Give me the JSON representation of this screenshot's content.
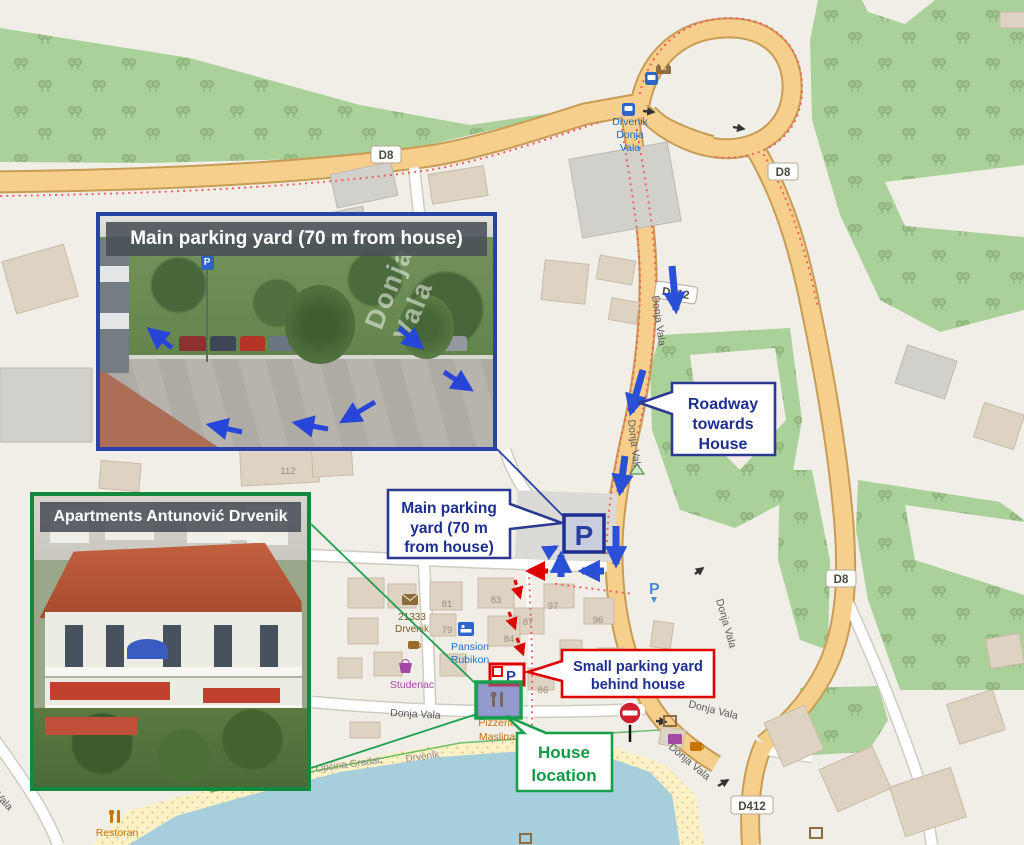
{
  "photos": {
    "main_parking": {
      "title": "Main parking yard (70 m from house)",
      "street_text": "Donja Vala"
    },
    "apartments": {
      "title": "Apartments Antunović Drvenik"
    }
  },
  "callouts": {
    "roadway": {
      "lines": [
        "Roadway",
        "towards",
        "House"
      ]
    },
    "main_parking": {
      "lines": [
        "Main parking",
        "yard (70 m",
        "from house)"
      ]
    },
    "small_parking": {
      "lines": [
        "Small parking yard",
        "behind house"
      ]
    },
    "house_location": {
      "lines": [
        "House",
        "location"
      ]
    }
  },
  "map": {
    "shields": [
      "D8",
      "D8",
      "D8",
      "D412",
      "D412"
    ],
    "street": "Donja Vala",
    "parking_symbol": "P",
    "bus_stop_lines": [
      "Drvenik",
      "Donja",
      "Vala"
    ],
    "post_lines": [
      "21333",
      "Drvenik"
    ],
    "pansion_lines": [
      "Pansion",
      "Rubikon"
    ],
    "supermarket": "Studenac",
    "pizzeria_lines": [
      "Pizzeria",
      "Maslina"
    ],
    "restaurant": "Restoran",
    "municipality": "Općina Gradac",
    "village": "Drvenik",
    "house_numbers": [
      "111",
      "112",
      "81",
      "83",
      "79",
      "84",
      "87",
      "97",
      "96",
      "86"
    ]
  },
  "colors": {
    "navy": "#1e2f8f",
    "arrow_blue": "#2a50d6",
    "red": "#e00000",
    "green": "#17a04b",
    "forest": "#abd19b",
    "water": "#a6cfdb",
    "road": "#f7cf8d"
  }
}
